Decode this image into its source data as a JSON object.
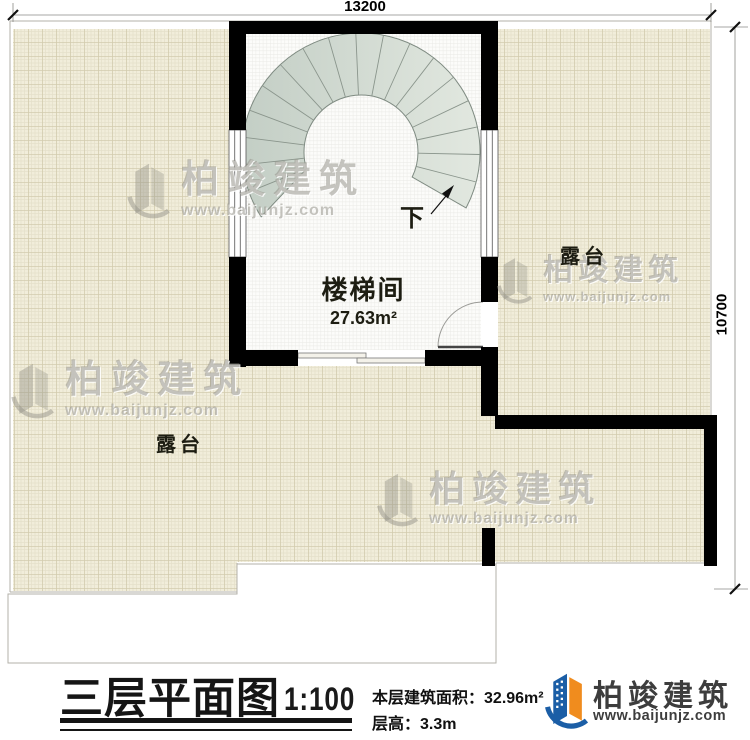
{
  "dimensions": {
    "top": "13200",
    "right": "10700"
  },
  "plan": {
    "stair": {
      "center": [
        361,
        152
      ],
      "r_outer": 119,
      "r_inner": 57,
      "start_angle": 28,
      "end_angle": 147,
      "inner_left_angle": 163,
      "inner_right_angle": 26,
      "steps": 18,
      "direction_label": "下"
    },
    "rooms": {
      "stairwell": {
        "label": "楼梯间",
        "area": "27.63m²"
      },
      "terrace_right": {
        "label": "露台"
      },
      "terrace_left": {
        "label": "露台"
      }
    }
  },
  "title_block": {
    "title": "三层平面图",
    "scale": "1:100",
    "area_label": "本层建筑面积：",
    "area_value": "32.96m²",
    "floor_height_label": "层高：",
    "floor_height_value": "3.3m"
  },
  "brand": {
    "name": "柏竣建筑",
    "url": "www.baijunjz.com"
  },
  "watermark": {
    "name": "柏竣建筑",
    "url": "www.baijunjz.com"
  },
  "colors": {
    "wall": "#000000",
    "terrace_bg": "#f1edda",
    "terrace_grid_major": "#d2cbae",
    "terrace_grid_minor": "#e5e0ca",
    "stair_fill_dark": "#c3cec5",
    "stair_fill_light": "#e2e8e0",
    "logo_blue": "#1b5ea6",
    "logo_orange": "#f08c1e"
  }
}
